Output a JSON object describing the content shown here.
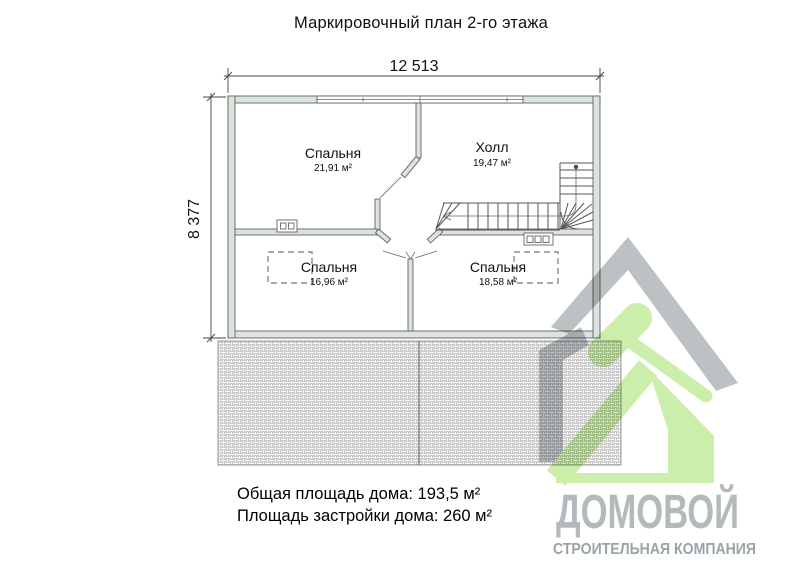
{
  "title": "Маркировочный план 2-го этажа",
  "dimensions": {
    "width": "12 513",
    "height": "8 377"
  },
  "rooms": [
    {
      "name": "Спальня",
      "area": "21,91 м²"
    },
    {
      "name": "Холл",
      "area": "19,47 м²"
    },
    {
      "name": "Спальня",
      "area": "16,96 м²"
    },
    {
      "name": "Спальня",
      "area": "18,58 м²"
    }
  ],
  "summary": {
    "total_area": "Общая площадь дома: 193,5 м²",
    "footprint_area": "Площадь застройки дома: 260 м²"
  },
  "logo": {
    "name": "ДОМОВОЙ",
    "tagline": "СТРОИТЕЛЬНАЯ КОМПАНИЯ"
  },
  "colors": {
    "wall_fill": "#dce3dd",
    "drawing_line": "#555555",
    "logo_gray": "#b7bcbf",
    "logo_green": "#c7eda4",
    "tagline_gray": "#9aa3a8",
    "hatch_line": "#b9b9b9"
  }
}
